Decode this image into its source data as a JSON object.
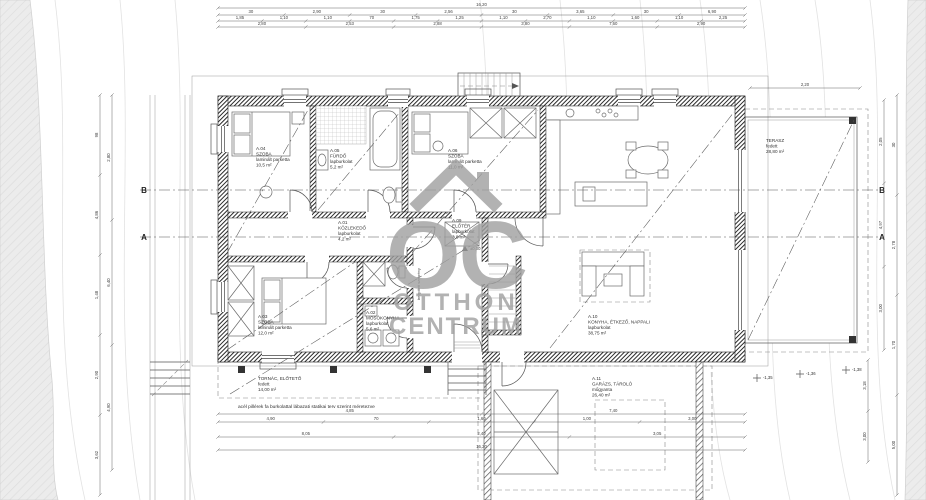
{
  "watermark": {
    "monogram": "OC",
    "line1": "OTTHON",
    "line2": "CENTRUM"
  },
  "rooms": {
    "a04": {
      "id": "A.04",
      "name": "SZOBA",
      "finish": "laminált parketta",
      "area": "10,5 m²"
    },
    "a05": {
      "id": "A.05",
      "name": "FÜRDŐ",
      "finish": "lapburkolat",
      "area": "5,2 m²"
    },
    "a06": {
      "id": "A.06",
      "name": "SZOBA",
      "finish": "laminált parketta",
      "area": "11,0 m²"
    },
    "a01": {
      "id": "A.01",
      "name": "KÖZLEKEDŐ",
      "finish": "lapburkolat",
      "area": "4,2 m²"
    },
    "a09": {
      "id": "A.09",
      "name": "ELŐTÉR",
      "finish": "lapburkolat",
      "area": "3,8 m²"
    },
    "a03": {
      "id": "A.03",
      "name": "SZOBA",
      "finish": "laminált parketta",
      "area": "12,0 m²"
    },
    "a02": {
      "id": "A.02",
      "name": "MOSÓKONYHA",
      "finish": "lapburkolat",
      "area": "5,6 m²"
    },
    "a10": {
      "id": "A.10",
      "name": "KONYHA, ÉTKEZŐ, NAPPALI",
      "finish": "lapburkolat",
      "area": "38,75 m²"
    },
    "a11": {
      "id": "A.11",
      "name": "GARÁZS, TÁROLÓ",
      "finish": "műgyanta",
      "area": "26,40 m²"
    },
    "terasz": {
      "name": "TERASZ",
      "finish": "fedett",
      "area": "28,80 m²"
    },
    "tornac": {
      "name": "TORNÁC, ELŐTETŐ",
      "finish": "fedett",
      "area": "14,00 m²"
    }
  },
  "labels": {
    "wardrobe_vertical": "beépített szekrény",
    "note": "acél pillérek fa burkolattal lábazati statikai terv szerint méretezve"
  },
  "sections": {
    "a": "A",
    "b": "B"
  },
  "levels": {
    "entry": "±0,00",
    "g1": "-1,35",
    "g2": "-1,36",
    "g3": "-1,38"
  },
  "dims": {
    "top_total": [
      "16,20"
    ],
    "top_row2": [
      "30",
      "2,90",
      "30",
      "2,56",
      "30",
      "3,65",
      "30",
      "6,90"
    ],
    "top_row3": [
      "1,85",
      "1,10",
      "1,10",
      "70",
      "1,75",
      "1,25",
      "1,10",
      "2,70",
      "1,10",
      "1,60",
      "1,10",
      "2,25"
    ],
    "top_row4": [
      "2,80",
      "2,53",
      "2,88",
      "3,80",
      "7,60",
      "2,90"
    ],
    "terrace_top": [
      "2,20"
    ],
    "bottom_row1": [
      "4,85",
      "7,40"
    ],
    "bottom_row2": [
      "4,90",
      "70",
      "1,60",
      "1,00",
      "3,00"
    ],
    "bottom_row3": [
      "8,05",
      "2,40",
      "3,05"
    ],
    "bottom_total": [
      "16,20"
    ],
    "left_col1": [
      "98",
      "4,86",
      "1,48",
      "2,90",
      "3,62"
    ],
    "left_col2": [
      "2,80",
      "6,40",
      "4,90"
    ],
    "right_col1": [
      "2,05",
      "4,97",
      "3,00"
    ],
    "right_col2": [
      "30",
      "2,78",
      "1,70",
      "5,00"
    ],
    "right_col3": [
      "3,18",
      "3,00"
    ]
  },
  "colors": {
    "wall": "#2f2f2f",
    "watermark": "#9f9f9f",
    "terrain": "#eaeaea",
    "dimension": "#4a4a4a"
  }
}
